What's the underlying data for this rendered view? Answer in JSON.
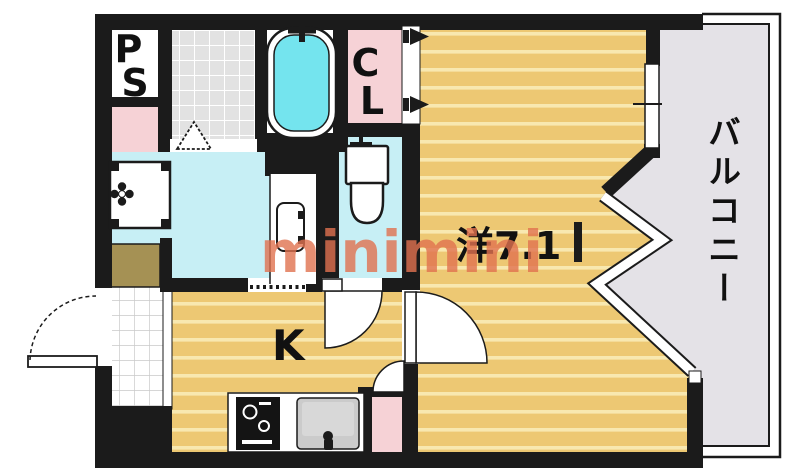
{
  "floorplan": {
    "watermark": "minimini",
    "rooms": {
      "pipe_space": {
        "label": "PS"
      },
      "closet": {
        "label": "CL"
      },
      "western_room": {
        "label": "洋7.1"
      },
      "kitchen": {
        "label": "K"
      },
      "balcony": {
        "label": "バルコニー"
      }
    },
    "colors": {
      "wall": "#1b1b1b",
      "wood_floor": "#edc873",
      "wood_stripe": "#f8e8b0",
      "wet_area_floor": "#c7eff5",
      "bathtub_water": "#74e4ee",
      "closet_pink": "#f6d2d6",
      "balcony_gray": "#e4e2e7",
      "tile_gray": "#e2e2e2",
      "shoe_cabinet_khaki": "#a59154",
      "watermark_color": "#e17250"
    }
  }
}
